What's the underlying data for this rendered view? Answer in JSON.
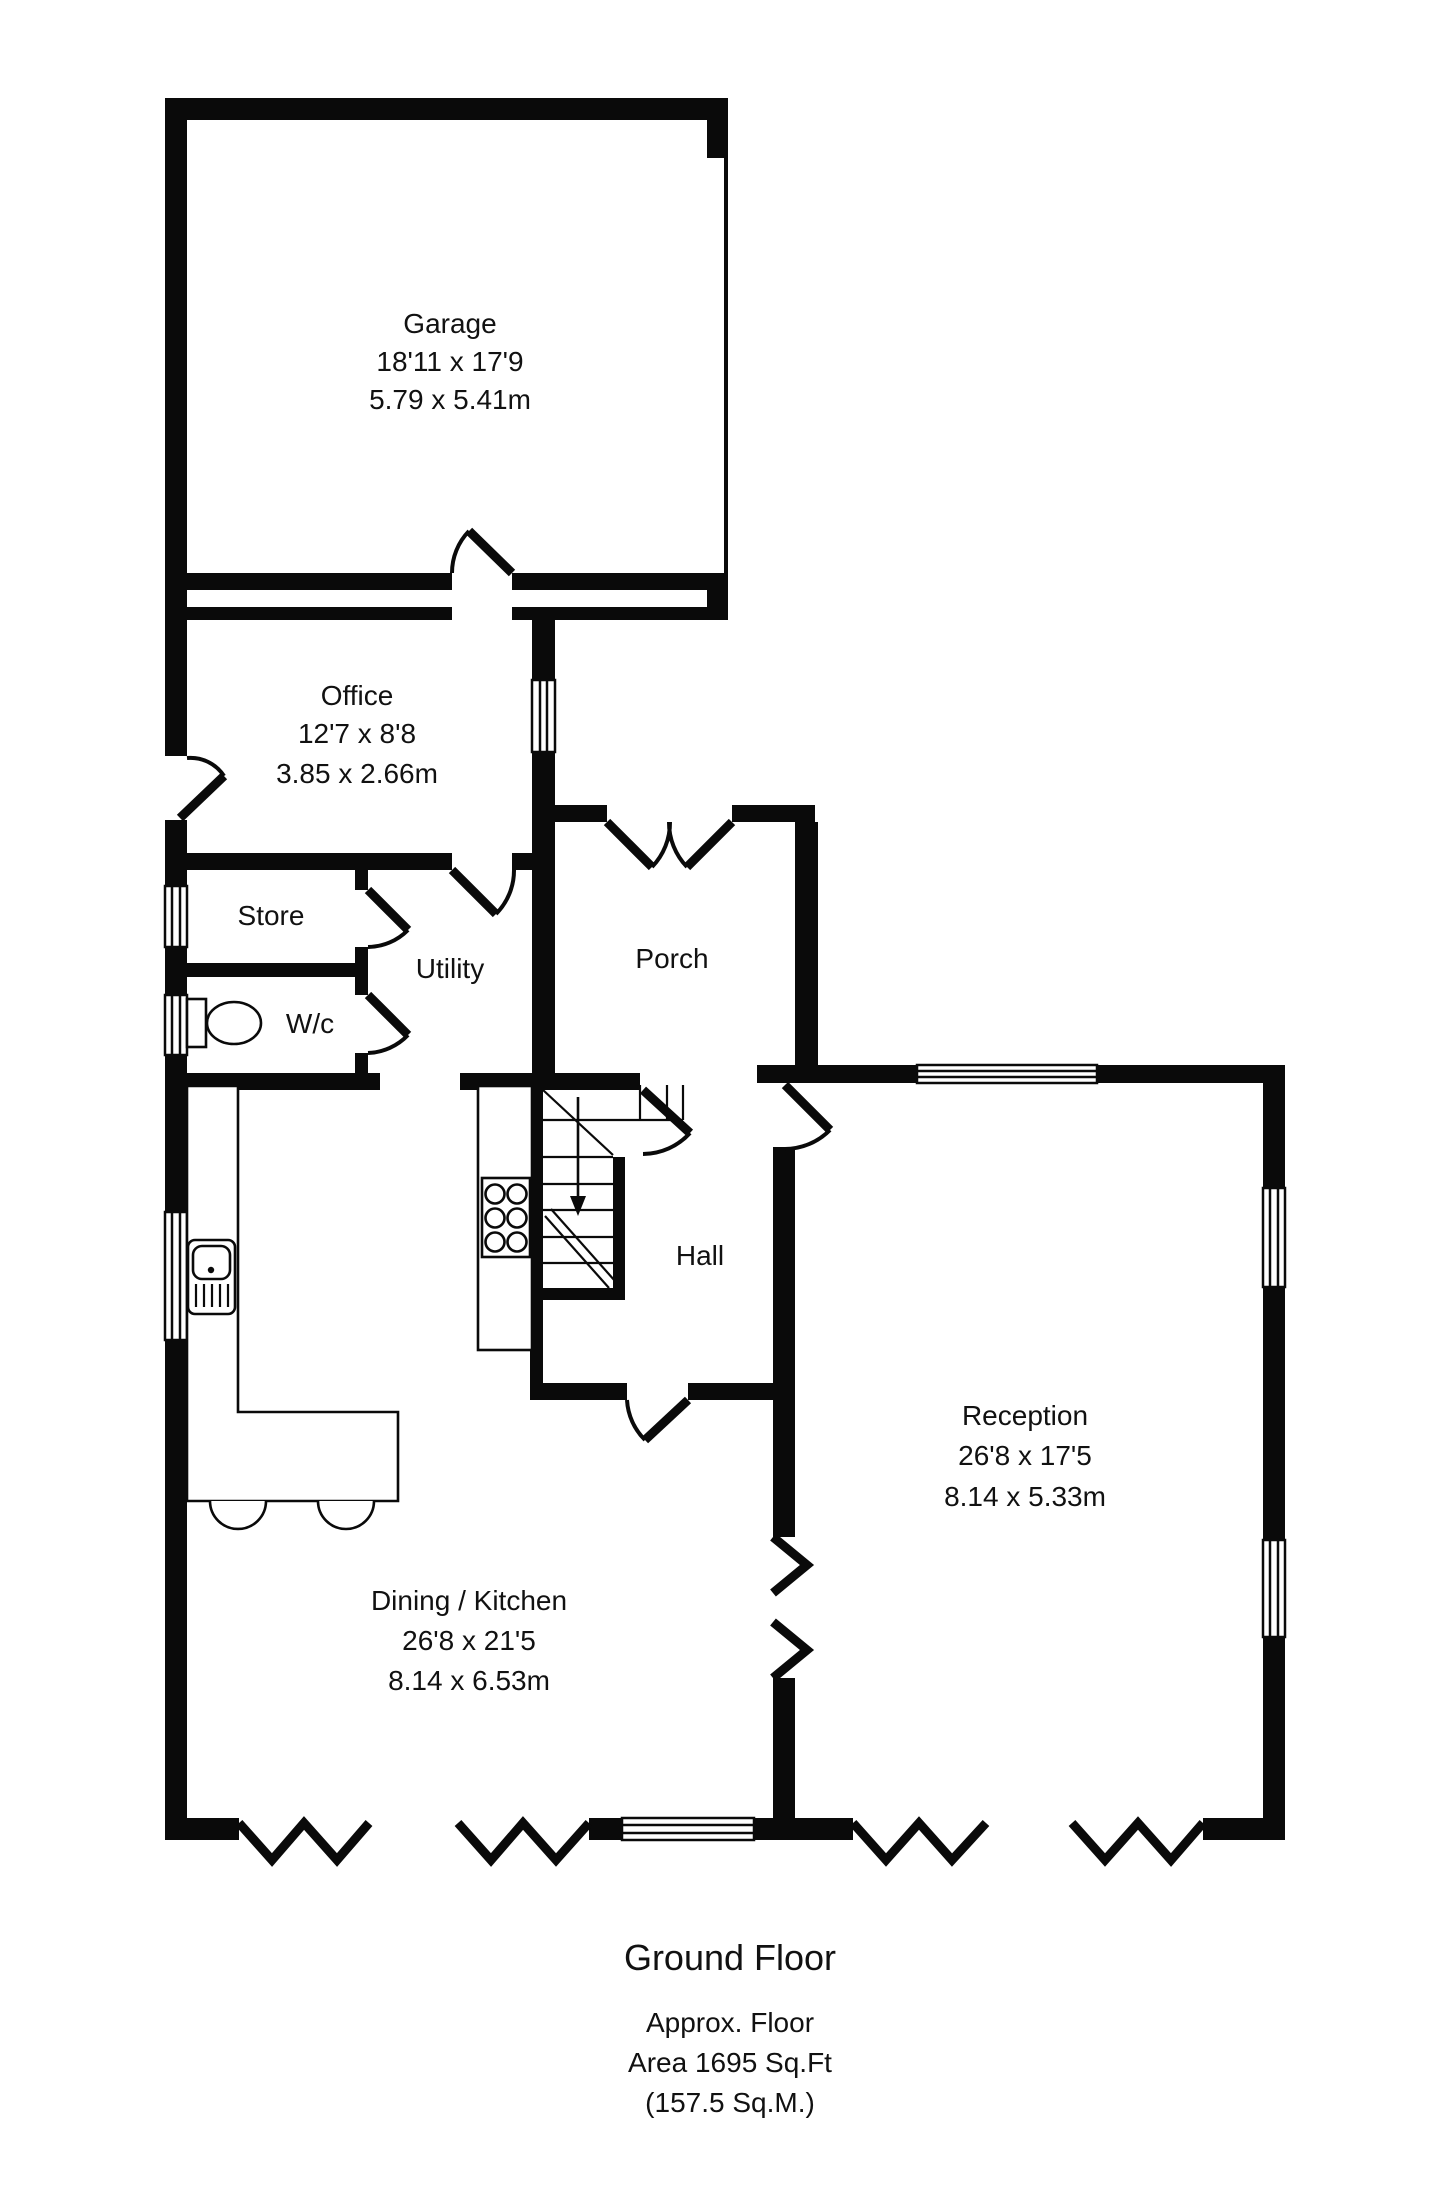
{
  "rooms": {
    "garage": {
      "label": "Garage",
      "dim_imperial": "18'11 x 17'9",
      "dim_metric": "5.79 x 5.41m"
    },
    "office": {
      "label": "Office",
      "dim_imperial": "12'7 x 8'8",
      "dim_metric": "3.85 x 2.66m"
    },
    "store": {
      "label": "Store"
    },
    "utility": {
      "label": "Utility"
    },
    "wc": {
      "label": "W/c"
    },
    "porch": {
      "label": "Porch"
    },
    "hall": {
      "label": "Hall"
    },
    "reception": {
      "label": "Reception",
      "dim_imperial": "26'8 x 17'5",
      "dim_metric": "8.14 x 5.33m"
    },
    "dining_kitchen": {
      "label": "Dining / Kitchen",
      "dim_imperial": "26'8 x 21'5",
      "dim_metric": "8.14 x 6.53m"
    }
  },
  "footer": {
    "title": "Ground Floor",
    "area_line1": "Approx. Floor",
    "area_line2": "Area 1695 Sq.Ft",
    "area_line3": "(157.5 Sq.M.)"
  },
  "colors": {
    "wall": "#0a0a0a",
    "background": "#ffffff",
    "text": "#111111"
  }
}
